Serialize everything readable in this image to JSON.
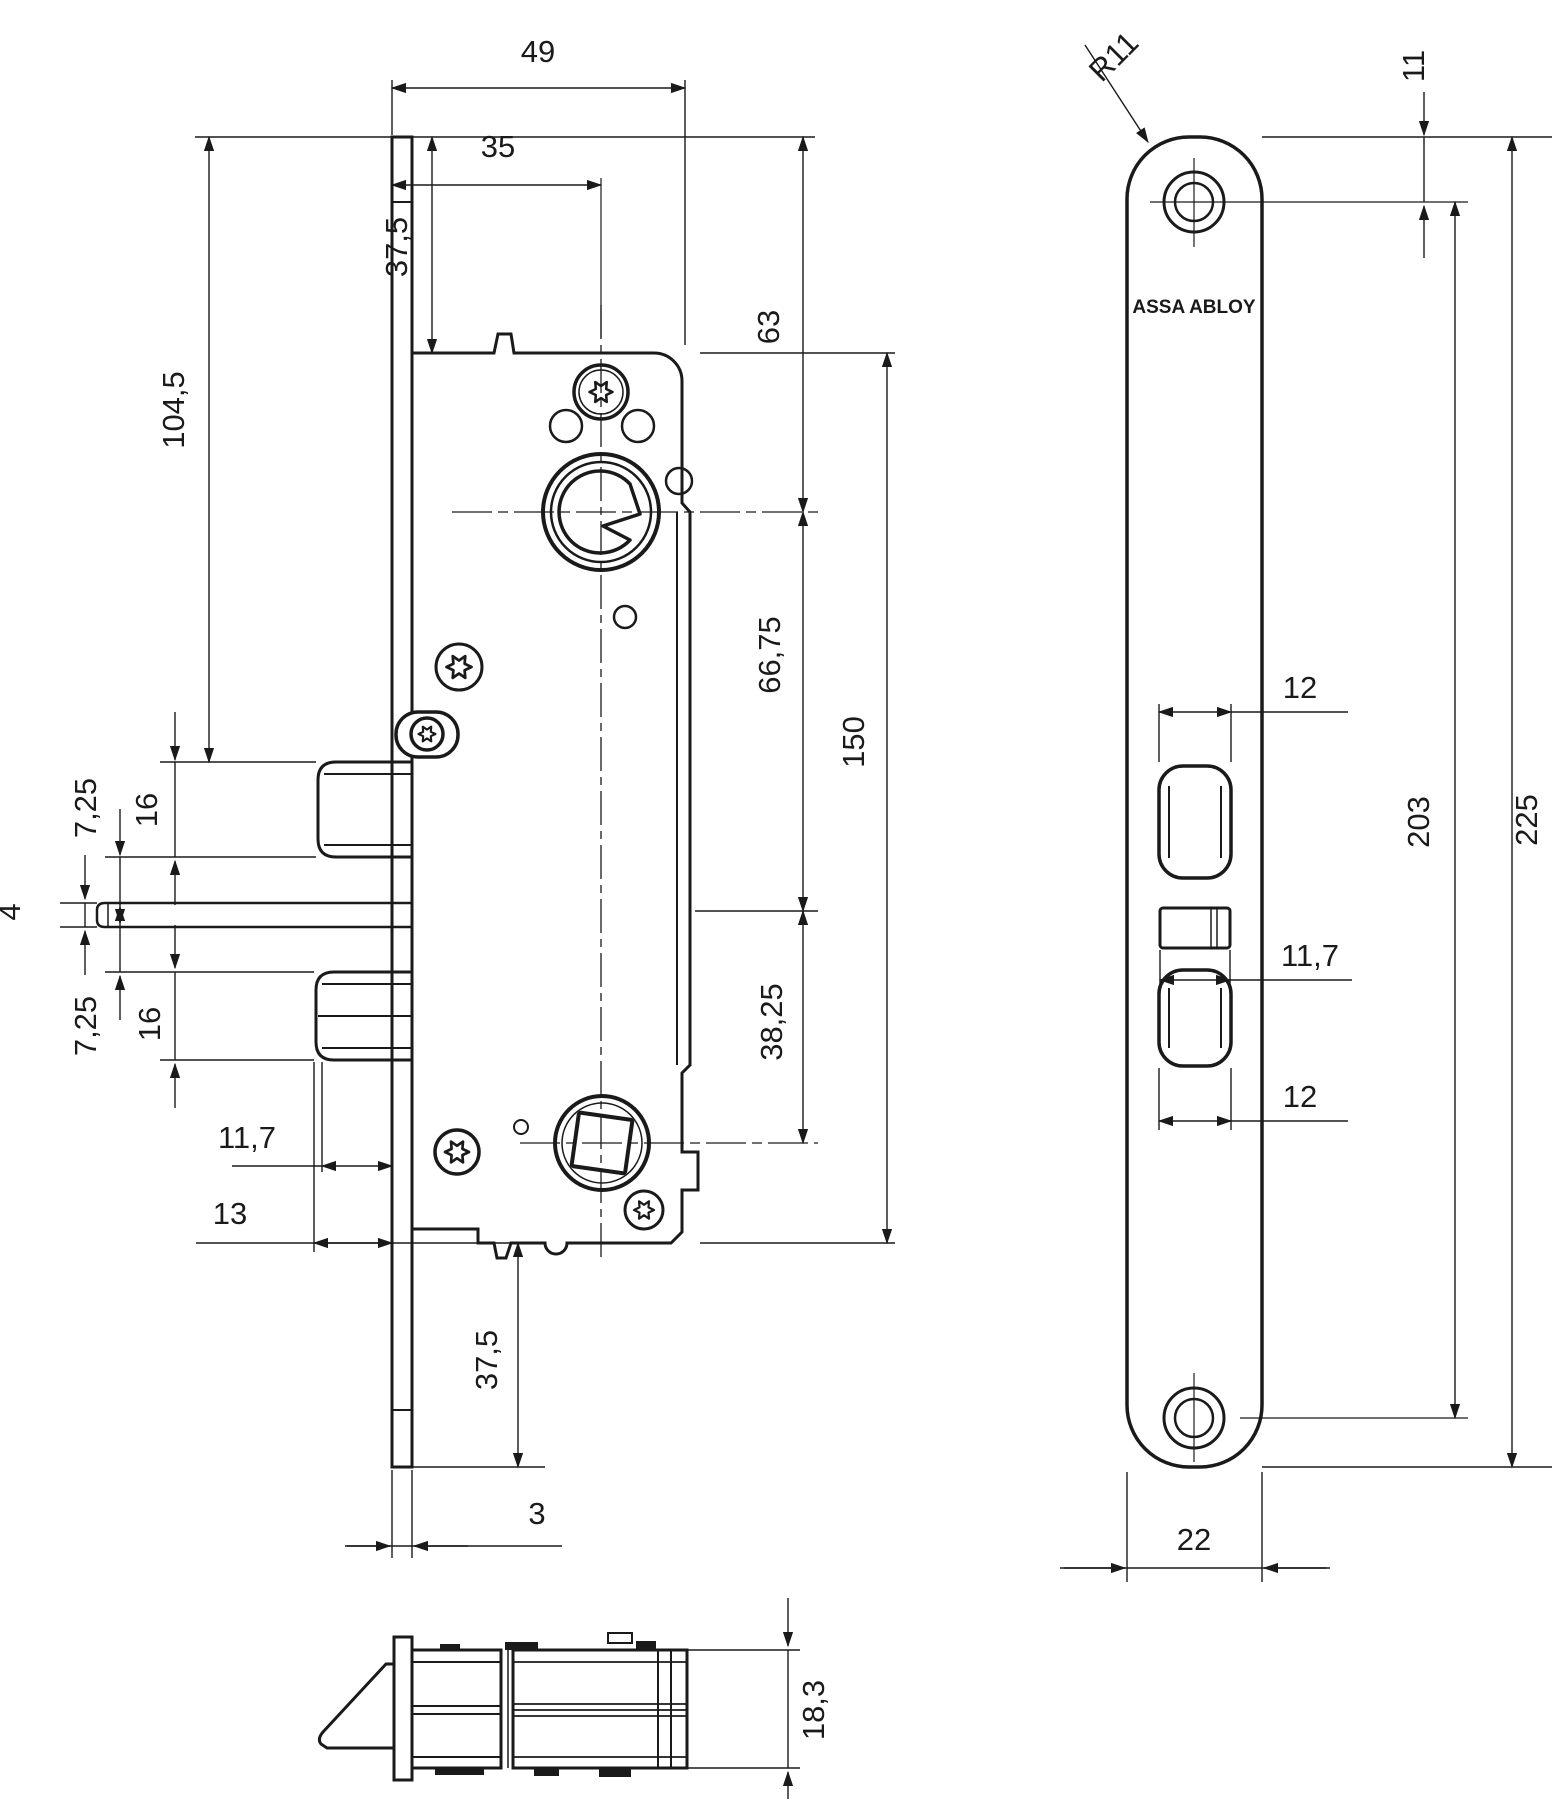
{
  "drawing": {
    "background": "#ffffff",
    "line_color": "#1a1a1a",
    "brand": "ASSA ABLOY",
    "left_view": {
      "total_width": "49",
      "backset": "35",
      "top_offset": "37,5",
      "upper_height": "104,5",
      "cylinder_offset": "63",
      "center_distance": "66,75",
      "case_height": "150",
      "spindle_offset": "38,25",
      "gap_upper": "7,25",
      "bolt_upper": "16",
      "bar_thickness": "4",
      "bolt_lower": "16",
      "gap_lower": "7,25",
      "protrusion_inner": "11,7",
      "protrusion_outer": "13",
      "bottom_offset": "37,5",
      "plate_thickness": "3"
    },
    "front_view": {
      "corner_radius": "R11",
      "hole_top_offset": "11",
      "bolt_width_upper": "12",
      "slot_width": "11,7",
      "bolt_width_lower": "12",
      "hole_spacing": "203",
      "plate_height": "225",
      "plate_width": "22"
    },
    "top_view": {
      "case_depth": "18,3"
    }
  }
}
